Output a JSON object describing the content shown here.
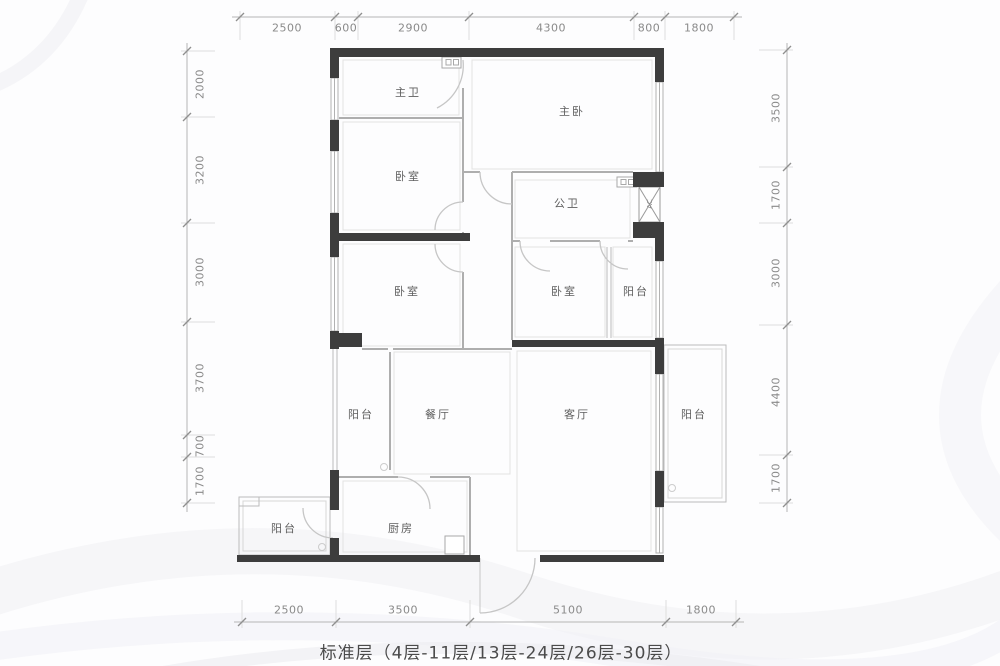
{
  "plan": {
    "caption": "标准层（4层-11层/13层-24层/26层-30层）",
    "rooms": [
      {
        "id": "master-bath",
        "label": "主卫"
      },
      {
        "id": "master-bedroom",
        "label": "主卧"
      },
      {
        "id": "bedroom-top-left",
        "label": "卧室"
      },
      {
        "id": "public-bath",
        "label": "公卫"
      },
      {
        "id": "ac-shaft",
        "label": "AC"
      },
      {
        "id": "bedroom-mid-left",
        "label": "卧室"
      },
      {
        "id": "bedroom-mid-right",
        "label": "卧室"
      },
      {
        "id": "balcony-mid-right",
        "label": "阳台"
      },
      {
        "id": "balcony-dining",
        "label": "阳台"
      },
      {
        "id": "dining-room",
        "label": "餐厅"
      },
      {
        "id": "living-room",
        "label": "客厅"
      },
      {
        "id": "balcony-living",
        "label": "阳台"
      },
      {
        "id": "balcony-bottom-left",
        "label": "阳台"
      },
      {
        "id": "kitchen",
        "label": "厨房"
      }
    ],
    "dimensions": {
      "top": {
        "values": [
          "2500",
          "600",
          "2900",
          "4300",
          "800",
          "1800"
        ]
      },
      "left": {
        "values": [
          "2000",
          "3200",
          "3000",
          "3700",
          "700",
          "1700"
        ]
      },
      "right": {
        "values": [
          "3500",
          "1700",
          "3000",
          "4400",
          "1700"
        ]
      },
      "bottom": {
        "values": [
          "2500",
          "3500",
          "5100",
          "1800"
        ]
      }
    },
    "colors": {
      "wall": "#3d3d3d",
      "thin_wall": "#aeaeae",
      "window": "#b2b2b2",
      "door_arc": "#c6c6c6",
      "dim_line": "#b5b5b5",
      "dim_text": "#8a8a8a",
      "room_text": "#5e5e5e",
      "caption_text": "#4b4b4b"
    }
  }
}
